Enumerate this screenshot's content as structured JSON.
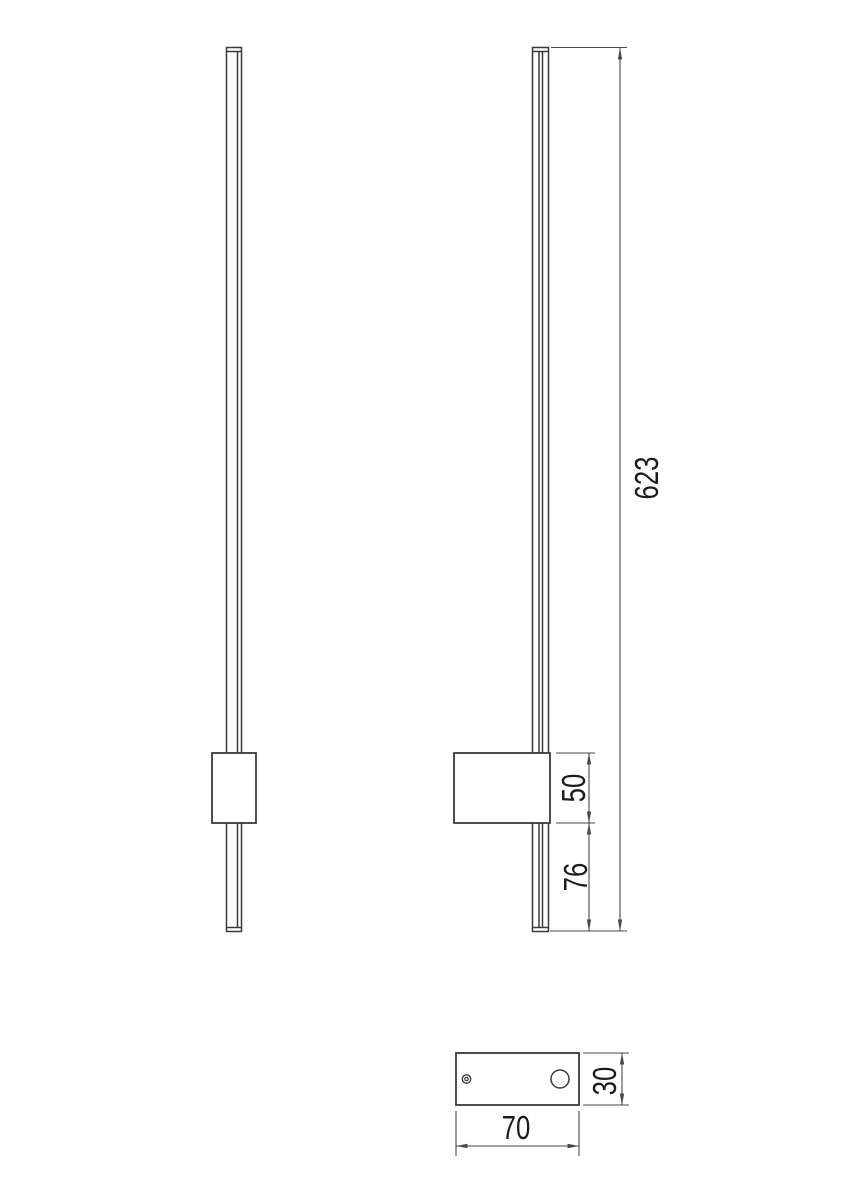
{
  "drawing": {
    "type": "technical-dimension-drawing",
    "colors": {
      "background": "#ffffff",
      "object_line": "#3a3a3a",
      "dim_line": "#4a4a4a",
      "text": "#1c1c1c"
    },
    "views": {
      "front": {
        "name": "front-view"
      },
      "side": {
        "name": "side-view"
      },
      "bottom": {
        "name": "bottom-view"
      }
    },
    "dimensions": {
      "total_height": {
        "value": "623",
        "orientation": "vertical"
      },
      "box_height": {
        "value": "50",
        "orientation": "vertical"
      },
      "box_to_end": {
        "value": "76",
        "orientation": "vertical"
      },
      "base_width": {
        "value": "70",
        "orientation": "horizontal"
      },
      "base_depth": {
        "value": "30",
        "orientation": "vertical"
      }
    }
  }
}
